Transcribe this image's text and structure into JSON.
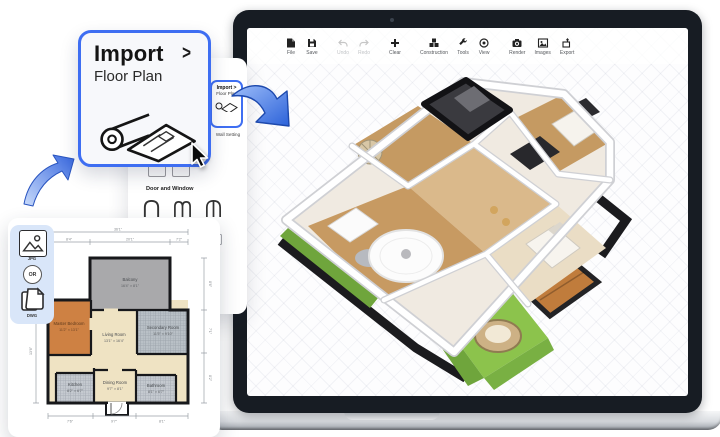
{
  "toolbar": {
    "items": [
      {
        "label": "File"
      },
      {
        "label": "Save"
      },
      {
        "label": "Undo"
      },
      {
        "label": "Redo"
      },
      {
        "label": "Clear"
      },
      {
        "label": "Construction"
      },
      {
        "label": "Tools"
      },
      {
        "label": "View"
      },
      {
        "label": "Render"
      },
      {
        "label": "Images"
      },
      {
        "label": "Export"
      }
    ]
  },
  "callout": {
    "title": "Import",
    "chevron": ">",
    "subtitle": "Floor Plan"
  },
  "sidebar": {
    "mini": {
      "title": "Import >",
      "subtitle": "Floor Plan"
    },
    "wall_setting": "Wall Setting",
    "section": "Door and Window"
  },
  "formats": {
    "jpg": "JPG",
    "or": "OR",
    "dwg": "DWG"
  },
  "plan2d": {
    "rooms": {
      "balcony": {
        "name": "Balcony",
        "dims": "16'4\" × 8'1\""
      },
      "master": {
        "name": "Master Bedroom",
        "dims": "11'2\" × 13'1\""
      },
      "living": {
        "name": "Living Room",
        "dims": "13'1\" × 16'4\""
      },
      "secondary": {
        "name": "Secondary Room",
        "dims": "11'5\" × 9'10\""
      },
      "kitchen": {
        "name": "Kitchen",
        "dims": "8'2\" × 6'7\""
      },
      "dining": {
        "name": "Dining Room",
        "dims": "9'7\" × 8'1\""
      },
      "bath": {
        "name": "Bathroom",
        "dims": "8'1\" × 6'7\""
      }
    },
    "dims": {
      "top_total": "36'1\"",
      "top_a": "8'4\"",
      "top_b": "20'1\"",
      "top_c": "7'2\"",
      "left_a": "13'6\"",
      "right_a": "8'6\"",
      "right_b": "7'1\"",
      "right_c": "8'2\"",
      "bottom_a": "7'6\"",
      "bottom_b": "9'7\"",
      "bottom_c": "8'1\""
    }
  },
  "colors": {
    "accent_blue": "#3e6ef2",
    "arrow_blue": "#3f78e8",
    "bezel_dark": "#171c23",
    "wall_black": "#17181b",
    "master_orange": "#ce8143",
    "grass_green": "#8cc34c"
  }
}
